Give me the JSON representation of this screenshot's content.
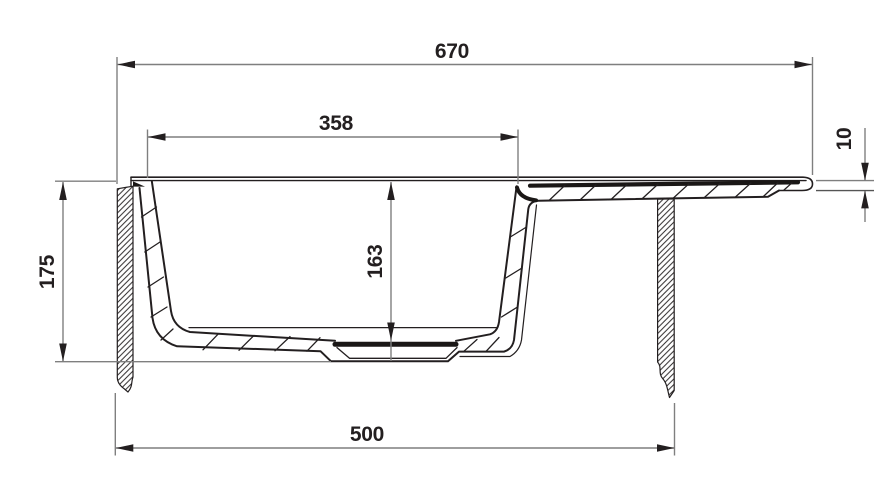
{
  "drawing": {
    "colors": {
      "background": "#ffffff",
      "profile_line": "#231f20",
      "dimension_line": "#7f7f7f",
      "arrow_and_text": "#231f20"
    },
    "dimensions": {
      "overall_width": "670",
      "bowl_top_width": "358",
      "rim_edge_thickness": "10",
      "overall_depth": "175",
      "bowl_depth": "163",
      "base_width": "500"
    }
  }
}
